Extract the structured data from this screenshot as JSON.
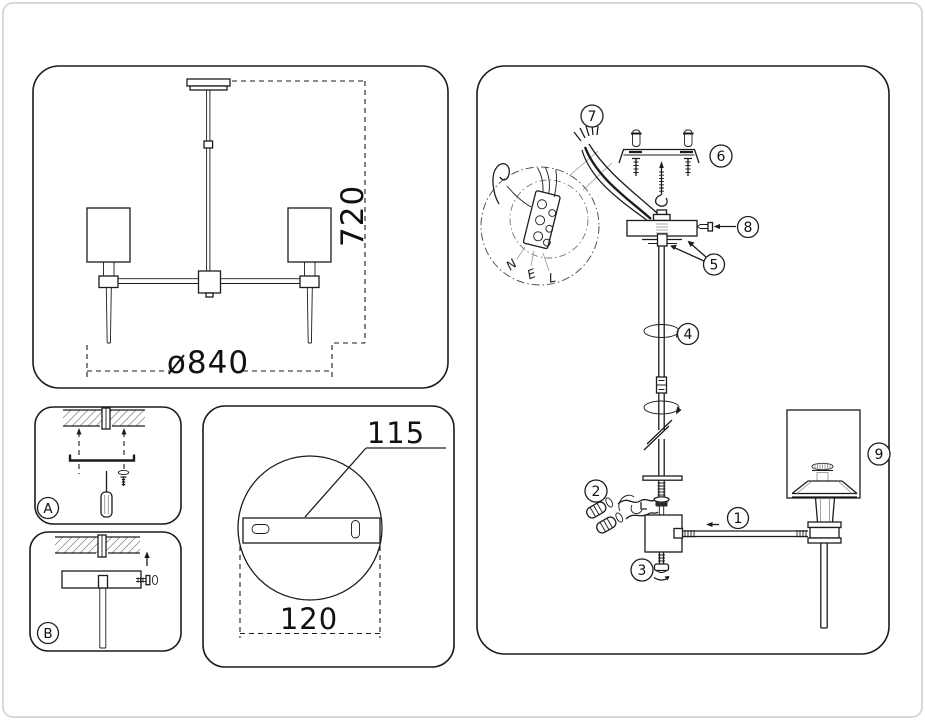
{
  "overview": {
    "height_dim": "720",
    "diameter_dim": "ø840"
  },
  "mount_steps": {
    "step_a": "A",
    "step_b": "B"
  },
  "bracket_detail": {
    "bracket_length": "115",
    "canopy_diameter": "120"
  },
  "assembly": {
    "callouts": [
      "1",
      "2",
      "3",
      "4",
      "5",
      "6",
      "7",
      "8",
      "9"
    ],
    "wiring": {
      "neutral": "N",
      "earth": "E",
      "live": "L"
    }
  },
  "colors": {
    "line": "#1c1c1c",
    "secondary_line": "#8a8a8a",
    "frame": "#d9d9d9",
    "background": "#ffffff"
  }
}
